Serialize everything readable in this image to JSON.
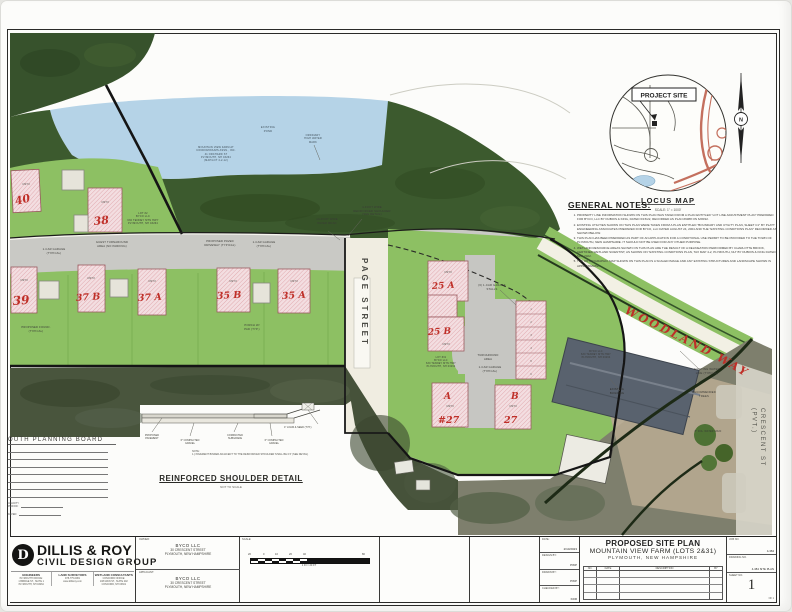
{
  "locus": {
    "project_site": "PROJECT SITE",
    "title": "LOCUS MAP",
    "scale_note": "SCALE: 1\" = 1000'",
    "north": "N"
  },
  "notes": {
    "heading": "GENERAL NOTES:",
    "items": [
      "PROPERTY LINE INFORMATION SHOWN ON THIS PLAN WAS TAKEN FROM A PLAN ENTITLED \"LOT LINE ADJUSTMENT PLAN\" PREPARED FOR BYCO, LLC BY DUBOIS & KING, DATED 6/15/22, RECORDED AS PLAN #9388 ON 6/28/22.",
      "EXISTING UTILITIES SHOWN ON THIS PLAN WERE TAKEN FROM A PLAN ENTITLED \"BOUNDARY AND UTILITY PLAN, SHEET C1\" BY PLATT ENGINEERING ASSOCIATES PREPARED FOR BYCO, LLC DATED AUGUST 24, 2004 AND THE \"EXISTING CONDITIONS PLAN\" RECORDED AS SHOWN BELOW.",
      "THIS PLAN HAS BEEN PREPARED AS PART OF AN APPLICATION FOR A CONDITIONAL USE PERMIT TO BE PROVIDED TO THE TOWN OF PLYMOUTH, NEW HAMPSHIRE. IT SHOULD NOT BE USED FOR ANY OTHER PURPOSE.",
      "WETLAND RESOURCE AREAS SHOWN ON THIS PLAN ARE THE RESULT OF A DELINEATION PERFORMED BY CHARLOTTE BROOK, CERTIFIED WETLAND SCIENTIST, AS SHOWN ON \"EXISTING CONDITIONS PLAN, TAX MAP 4-2, PLYMOUTH, NH\" BY DUBOIS & KING DATED MAY 2022.",
      "THE ORTHOGRAPHIC MAP SHOWN ON THIS PLAN IS A SCALED IMAGE AND ANY EXISTING STRUCTURES AND LANDSCAPE SHOWN IS APPROXIMATE."
    ]
  },
  "plan": {
    "streets": {
      "page_street": "PAGE STREET",
      "woodland_way": "WOODLAND WAY",
      "crescent_st": "CRESCENT ST",
      "crescent_pvt": "(PVT.)"
    },
    "lots": {
      "lot40": "40",
      "lot38": "38",
      "lot39": "39",
      "lot37b": "37 B",
      "lot37a": "37 A",
      "lot35b": "35 B",
      "lot35a": "35 A",
      "lot25a": "25 A",
      "lot25b": "25 B",
      "lot_a": "A",
      "lot_a_no": "#27",
      "lot_b": "B",
      "lot_b_no": "27"
    },
    "unit_label": "UNIT #",
    "stalls": [
      "1",
      "2",
      "3",
      "4",
      "5",
      "6"
    ],
    "labels": {
      "existing_pond": "EXISTING\nPOND",
      "pond_owner": "MOUNTAIN VIEW FARM AT\nCONDOMINIUMS ASSN., INC.\n41 ORCHARD ST\nPLYMOUTH, NH 03264\n(MAP/LOT 4-2-12)",
      "ohwm": "ORDINARY\nHIGH WATER\nMARK",
      "paved_road": "14-FOOT WIDE\nPAVED ROAD",
      "reinforced_shoulder": "4-FOOT WIDE\nREINFORCED SHOULDER\n(SEE DETAIL)",
      "garage_typ": "1-CAR GARAGE\n(TYPICAL)",
      "guest_turnaround": "GUEST TURNAROUND\nAREA (NO PARKING)",
      "lot2_owner": "LOT #2\nBYCO LLC\n630 TENNEY MTN HWY\nPLYMOUTH, NH 03264",
      "proposed_foundation": "PROPOSED FOUND.\n(TYPICAL)",
      "porch_typ": "PORCH W/\nPAD (TYP.)",
      "driveway_typ": "PROPOSED PAVED\nDRIVEWAY (TYPICAL)",
      "garage_stalls": "(6) 1-CAR GARAGE\nSTALLS",
      "lot31_owner": "LOT #31\nBYCO LLC\n630 TENNEY MTN HWY\nPLYMOUTH, NH 03264",
      "byco_parcel": "BYCO LLC\n630 TENNEY MTN HWY\nPLYMOUTH, NH 03264",
      "turnaround": "TURNAROUND\nAREA",
      "water_line": "EXISTING WATER\nLINE (TYPICAL)",
      "existing_building": "EXISTING\nBUILDING",
      "recommended_trees": "RECOMMENDED\nTREES",
      "water_main": "8\" DIA. WATER MAIN"
    }
  },
  "planning_board": {
    "heading": "OUTH PLANNING BOARD",
    "validity": "VALIDITY\nPERIOD:",
    "dated": "DATED:"
  },
  "shoulder_detail": {
    "title": "REINFORCED SHOULDER DETAIL",
    "not_to_scale": "NOT TO SCALE",
    "pavement": "PROPOSED\nPAVEMENT",
    "gravel_left": "6\" COMPACTED\nGRAVEL",
    "subgrade": "COMPACTED\nSUBGRADE",
    "gravel_right": "6\" COMPACTED\nGRAVEL",
    "loam": "4\" LOAM & SEED (TYP.)",
    "note": "NOTE:\n1.) PAVEMENT BINDER ADJACENT TO THE REINFORCED SHOULDER SHALL BE 0.5' (SEE DETAIL)"
  },
  "title_block": {
    "firm": {
      "emblem": "D",
      "name": "DILLIS & ROY",
      "tagline": "CIVIL DESIGN GROUP",
      "divisions": [
        "ENGINEERS",
        "LAND SURVEYORS",
        "WETLAND CONSULTANTS"
      ],
      "office1": "PLYMOUTH OFFICE:\n1 BRIDGE ST., SUITE 1\nPLYMOUTH, NH 03264",
      "office2": "978-775-0081\nwww.dillisroy.com",
      "office3": "CONCORD OFFICE:\n108 MAIN ST., SUITE 202\nCONCORD, NH 03301"
    },
    "owner": {
      "label": "OWNER:",
      "name": "BYCO LLC",
      "addr1": "30 CRESCENT STREET",
      "addr2": "PLYMOUTH, NEW HAMPSHIRE"
    },
    "applicant": {
      "label": "APPLICANT:",
      "name": "BYCO LLC",
      "addr1": "30 CRESCENT STREET",
      "addr2": "PLYMOUTH, NEW HAMPSHIRE"
    },
    "scale": {
      "label": "SCALE:",
      "ticks": [
        "20",
        "0",
        "10",
        "20",
        "40",
        "80"
      ],
      "caption": "1 IN = 20 FT"
    },
    "meta": {
      "date_label": "DATE:",
      "date": "2/10/2023",
      "design_label": "DESIGN BY:",
      "design": "PWP",
      "drawn_label": "DRAWN BY:",
      "drawn": "PWP",
      "checked_label": "CHECKED BY:",
      "checked": "KDR"
    },
    "title": {
      "line1": "PROPOSED SITE PLAN",
      "line2": "MOUNTAIN VIEW FARM (LOTS 2&31)",
      "line3": "PLYMOUTH, NEW HAMPSHIRE"
    },
    "revisions": {
      "no": "NO.",
      "date": "DATE",
      "description": "DESCRIPTION",
      "by": "BY"
    },
    "ids": {
      "job_label": "JOB NO.",
      "job": "4-384",
      "drawing_label": "DRAWING NO.",
      "drawing": "4-384 SITE PLAN",
      "sheet_label": "SHEET NO.",
      "sheet": "1",
      "of": "OF 1"
    }
  },
  "colors": {
    "site_green": "#8dc063",
    "forest_green": "#3c5a2e",
    "pond_blue": "#b5d3e7",
    "road_gray": "#c9c9c5",
    "accent_red": "#bf2f28",
    "building_pink": "#f3dee1"
  }
}
